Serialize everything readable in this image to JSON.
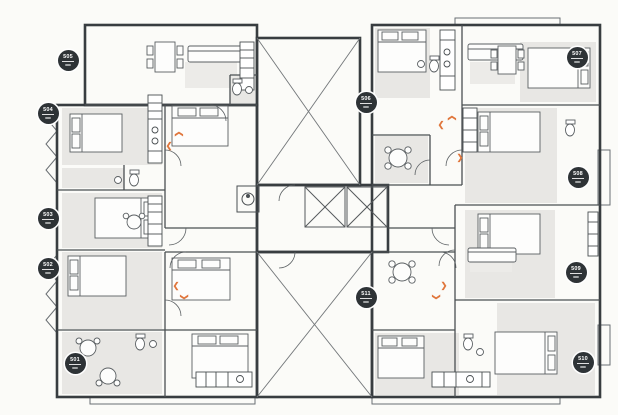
{
  "plan": {
    "kind": "residential-floor-plan",
    "units_visible": [
      "501",
      "502",
      "503",
      "504",
      "505",
      "506",
      "507",
      "508",
      "509",
      "510",
      "511"
    ]
  },
  "colors": {
    "background": "#fbfbf8",
    "wall": "#383d40",
    "interior_wall": "#4a4f52",
    "room_shade": "#e8e7e4",
    "furniture_line": "#5a5f62",
    "shaft_line": "#73777a",
    "accent": "#e0763c",
    "badge_bg": "#2e3336",
    "badge_text": "#ffffff"
  },
  "units": [
    {
      "number": "501",
      "x": 75,
      "y": 363
    },
    {
      "number": "502",
      "x": 48,
      "y": 268
    },
    {
      "number": "503",
      "x": 48,
      "y": 218
    },
    {
      "number": "504",
      "x": 48,
      "y": 113
    },
    {
      "number": "505",
      "x": 68,
      "y": 60
    },
    {
      "number": "506",
      "x": 366,
      "y": 102
    },
    {
      "number": "507",
      "x": 577,
      "y": 57
    },
    {
      "number": "508",
      "x": 578,
      "y": 177
    },
    {
      "number": "509",
      "x": 576,
      "y": 272
    },
    {
      "number": "510",
      "x": 583,
      "y": 362
    },
    {
      "number": "511",
      "x": 366,
      "y": 297
    }
  ],
  "entry_markers": [
    {
      "x": 169,
      "y": 146,
      "rot": 180
    },
    {
      "x": 179,
      "y": 134,
      "rot": 270
    },
    {
      "x": 176,
      "y": 286,
      "rot": 180
    },
    {
      "x": 184,
      "y": 297,
      "rot": 90
    },
    {
      "x": 441,
      "y": 125,
      "rot": 180
    },
    {
      "x": 452,
      "y": 118,
      "rot": 270
    },
    {
      "x": 460,
      "y": 158,
      "rot": 0
    },
    {
      "x": 444,
      "y": 286,
      "rot": 0
    },
    {
      "x": 436,
      "y": 297,
      "rot": 90
    }
  ],
  "glyphs": {
    "chevron": "❯"
  }
}
